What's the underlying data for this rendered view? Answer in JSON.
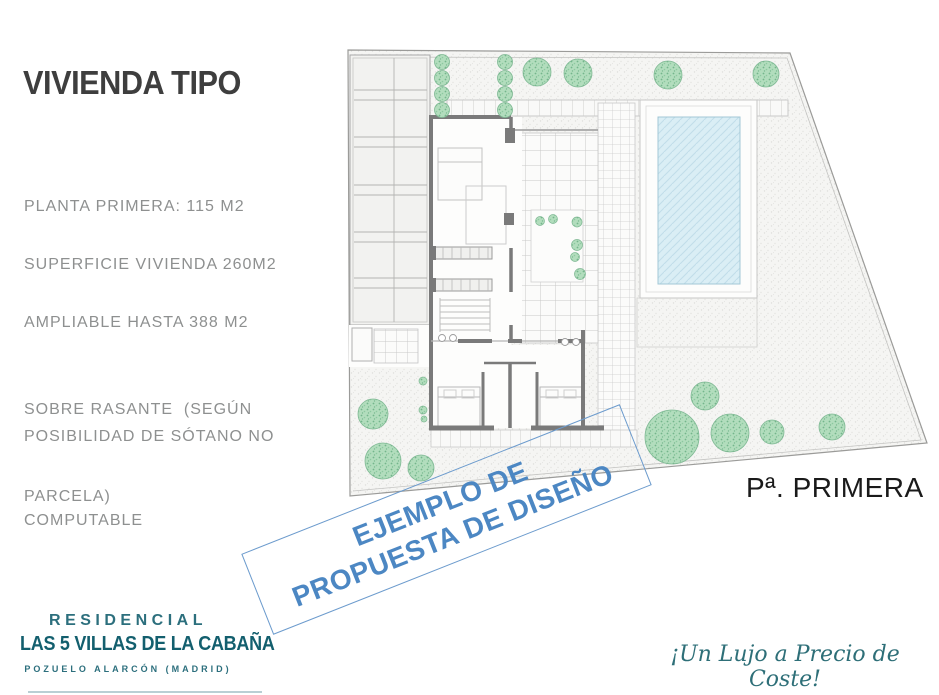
{
  "left_panel": {
    "title": "VIVIENDA TIPO",
    "specs": [
      {
        "lines": [
          "PLANTA PRIMERA: 115 M2"
        ]
      },
      {
        "lines": [
          "SUPERFICIE VIVIENDA 260M2"
        ]
      },
      {
        "lines": [
          "AMPLIABLE HASTA 388 M2",
          "SOBRE RASANTE  (SEGÚN",
          "PARCELA)"
        ]
      },
      {
        "lines": [
          "POSIBILIDAD DE SÓTANO NO",
          "COMPUTABLE"
        ]
      }
    ]
  },
  "banner": {
    "line1": "EJEMPLO DE",
    "line2": "PROPUESTA DE DISEÑO"
  },
  "plan": {
    "floor_label": "Pª. PRIMERA"
  },
  "footer": {
    "brand_top": "RESIDENCIAL",
    "brand_name": "LAS 5 VILLAS DE LA CABAÑA",
    "brand_location": "POZUELO ALARCÓN (MADRID)",
    "slogan": "¡Un Lujo a Precio de Coste!"
  },
  "colors": {
    "teal_brand": "#135f6e",
    "banner_blue": "#4c87c3",
    "tree_green": "#b2ddbd",
    "pool_blue": "#daeef5",
    "wall_gray": "#7a7a7a",
    "text_gray": "#8e9090"
  }
}
